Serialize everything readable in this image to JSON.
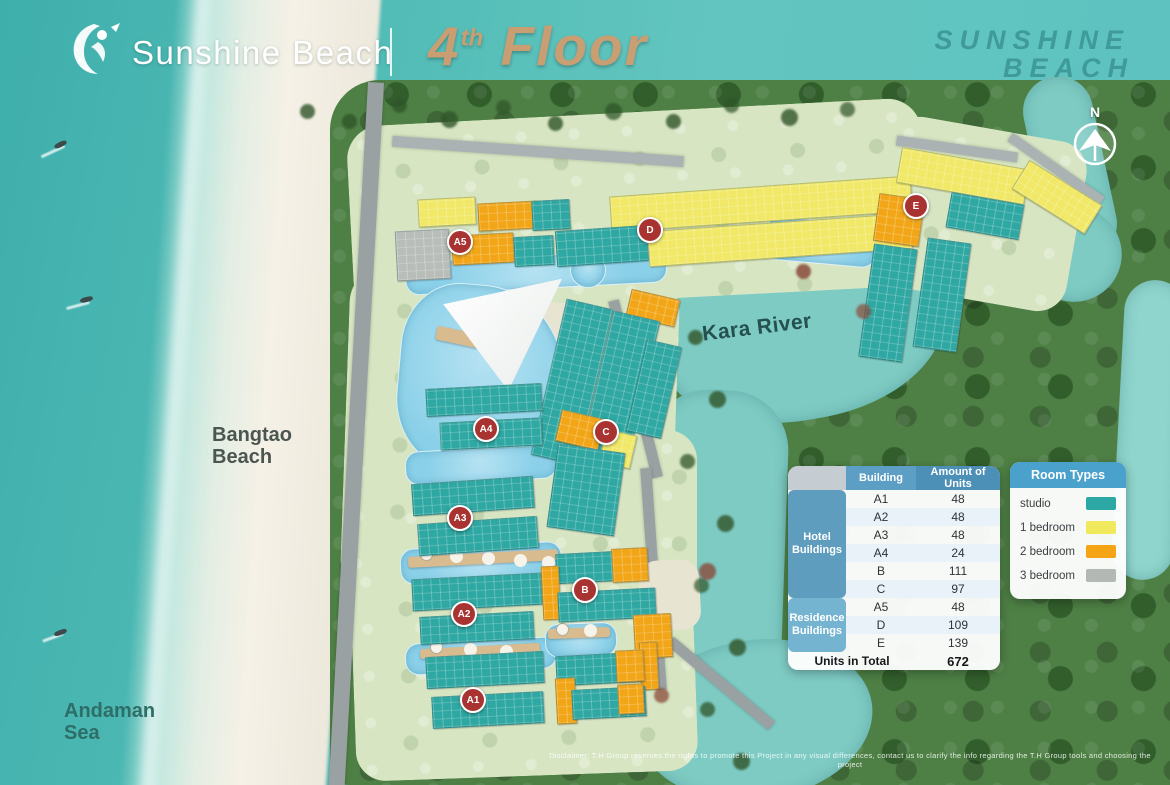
{
  "header": {
    "brand": "Sunshine Beach",
    "floor_number": "4",
    "floor_ordinal": "th",
    "floor_word": "Floor"
  },
  "watermark": {
    "line1": "SUNSHINE",
    "line2": "BEACH"
  },
  "compass": {
    "north_label": "N"
  },
  "map_labels": {
    "river": "Kara River",
    "beach_line1": "Bangtao",
    "beach_line2": "Beach",
    "sea_line1": "Andaman",
    "sea_line2": "Sea"
  },
  "building_markers": [
    {
      "label": "A5"
    },
    {
      "label": "D"
    },
    {
      "label": "E"
    },
    {
      "label": "A4"
    },
    {
      "label": "C"
    },
    {
      "label": "A3"
    },
    {
      "label": "A2"
    },
    {
      "label": "B"
    },
    {
      "label": "A1"
    }
  ],
  "units_table": {
    "col_building": "Building",
    "col_units": "Amount of Units",
    "group_hotel": "Hotel Buildings",
    "group_residence": "Residence Buildings",
    "rows": [
      {
        "building": "A1",
        "units": "48"
      },
      {
        "building": "A2",
        "units": "48"
      },
      {
        "building": "A3",
        "units": "48"
      },
      {
        "building": "A4",
        "units": "24"
      },
      {
        "building": "B",
        "units": "111"
      },
      {
        "building": "C",
        "units": "97"
      },
      {
        "building": "A5",
        "units": "48"
      },
      {
        "building": "D",
        "units": "109"
      },
      {
        "building": "E",
        "units": "139"
      }
    ],
    "total_label": "Units in Total",
    "total_value": "672"
  },
  "room_types": {
    "title": "Room Types",
    "items": [
      {
        "label": "studio",
        "color": "#2ba8a3"
      },
      {
        "label": "1 bedroom",
        "color": "#f0e95e"
      },
      {
        "label": "2 bedroom",
        "color": "#f4a414"
      },
      {
        "label": "3 bedroom",
        "color": "#b4b8b4"
      }
    ]
  },
  "disclaimer": "Disclaimer: T.H Group reserves the rights to promote this Project in any visual differences, contact us to clarify the info regarding the T.H Group tools and choosing the project",
  "colors": {
    "marker_red": "#a93331",
    "title_gold": "#c99e72",
    "table_header_blue": "#4d90b7",
    "group_hotel_blue": "#5e9dbd",
    "group_residence_blue": "#75b4d0",
    "studio_teal": "#2ba8a3",
    "one_bedroom_yellow": "#f0e95e",
    "two_bedroom_orange": "#f4a414",
    "three_bedroom_gray": "#b4b8b4",
    "sea_teal": "#52bcb6",
    "river_teal": "#7ecbc4"
  }
}
